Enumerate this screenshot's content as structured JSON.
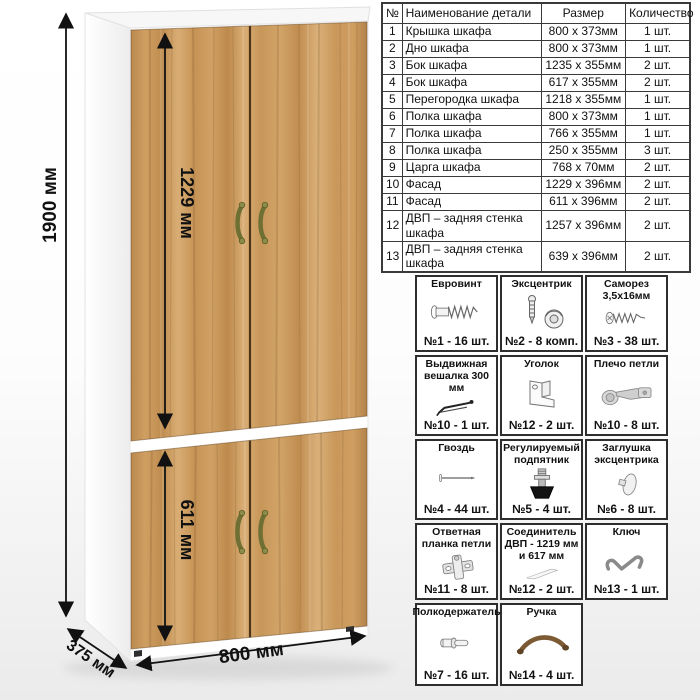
{
  "dimensions": {
    "height_label": "1900 мм",
    "top_door_label": "1229 мм",
    "bottom_door_label": "611 мм",
    "width_label": "800 мм",
    "depth_label": "375 мм"
  },
  "parts_table": {
    "headers": [
      "№",
      "Наименование детали",
      "Размер",
      "Количество"
    ],
    "rows": [
      [
        "1",
        "Крышка шкафа",
        "800 х 373мм",
        "1 шт."
      ],
      [
        "2",
        "Дно шкафа",
        "800 х 373мм",
        "1 шт."
      ],
      [
        "3",
        "Бок шкафа",
        "1235 х 355мм",
        "2 шт."
      ],
      [
        "4",
        "Бок шкафа",
        "617 х 355мм",
        "2 шт."
      ],
      [
        "5",
        "Перегородка шкафа",
        "1218 х 355мм",
        "1 шт."
      ],
      [
        "6",
        "Полка шкафа",
        "800 х 373мм",
        "1 шт."
      ],
      [
        "7",
        "Полка шкафа",
        "766 х 355мм",
        "1 шт."
      ],
      [
        "8",
        "Полка шкафа",
        "250 х 355мм",
        "3 шт."
      ],
      [
        "9",
        "Царга шкафа",
        "768 х 70мм",
        "2 шт."
      ],
      [
        "10",
        "Фасад",
        "1229 х 396мм",
        "2 шт."
      ],
      [
        "11",
        "Фасад",
        "611 х 396мм",
        "2 шт."
      ],
      [
        "12",
        "ДВП – задняя стенка шкафа",
        "1257 х 396мм",
        "2 шт."
      ],
      [
        "13",
        "ДВП – задняя стенка шкафа",
        "639 х 396мм",
        "2 шт."
      ]
    ]
  },
  "hardware": {
    "items": [
      {
        "title": "Евровинт",
        "count": "№1 - 16 шт."
      },
      {
        "title": "Эксцентрик",
        "count": "№2 - 8 комп."
      },
      {
        "title": "Саморез 3,5х16мм",
        "count": "№3 - 38 шт."
      },
      {
        "title": "Выдвижная вешалка 300 мм",
        "count": "№10 - 1 шт."
      },
      {
        "title": "Уголок",
        "count": "№12 - 2 шт."
      },
      {
        "title": "Плечо петли",
        "count": "№10 - 8 шт."
      },
      {
        "title": "Гвоздь",
        "count": "№4 - 44 шт."
      },
      {
        "title": "Регулируемый подпятник",
        "count": "№5 - 4 шт."
      },
      {
        "title": "Заглушка эксцентрика",
        "count": "№6 - 8 шт."
      },
      {
        "title": "Ответная планка петли",
        "count": "№11 - 8 шт."
      },
      {
        "title": "Соединитель ДВП - 1219 мм и 617 мм",
        "count": "№12 - 2 шт."
      },
      {
        "title": "Ключ",
        "count": "№13 - 1 шт."
      },
      {
        "title": "Полкодержатель",
        "count": "№7 - 16 шт."
      },
      {
        "title": "Ручка",
        "count": "№14 - 4 шт."
      }
    ]
  },
  "colors": {
    "wood": "#c9975a",
    "cabinet_body": "#ffffff",
    "door_gap": "#4d3418",
    "handle_brass_green": "#6e6f33",
    "dimension_line": "#111111",
    "table_border": "#3a3a3a"
  }
}
